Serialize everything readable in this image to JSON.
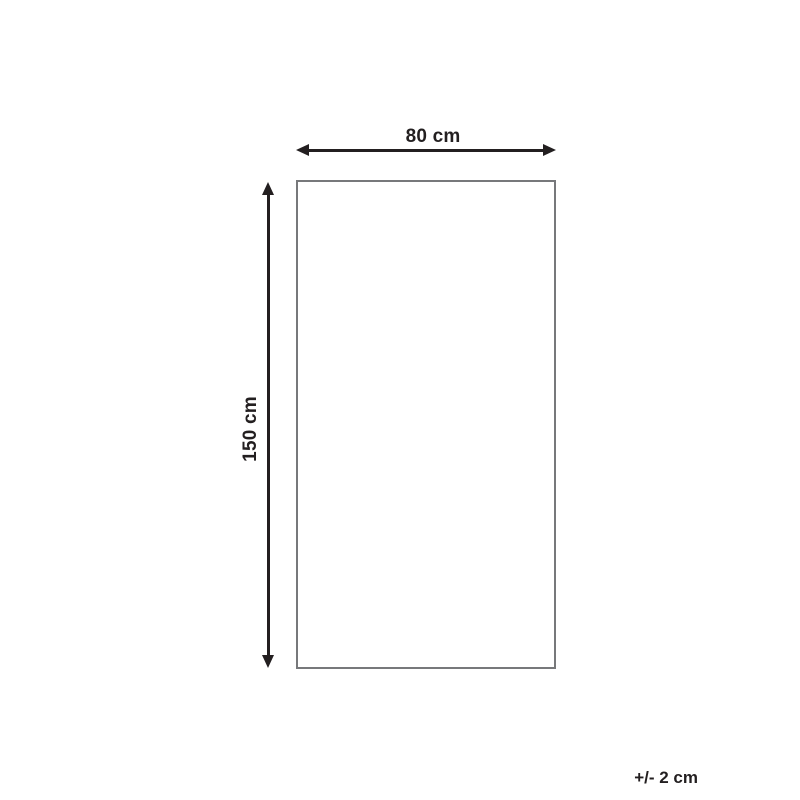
{
  "diagram": {
    "type": "product-dimension-diagram",
    "shape": "rectangle",
    "width_label": "80 cm",
    "height_label": "150 cm",
    "tolerance_label": "+/- 2 cm",
    "dimensions": {
      "width_cm": 80,
      "height_cm": 150,
      "tolerance_cm": 2
    },
    "colors": {
      "arrow": "#231f20",
      "rectangle_border": "#77787b",
      "background": "#ffffff"
    }
  }
}
